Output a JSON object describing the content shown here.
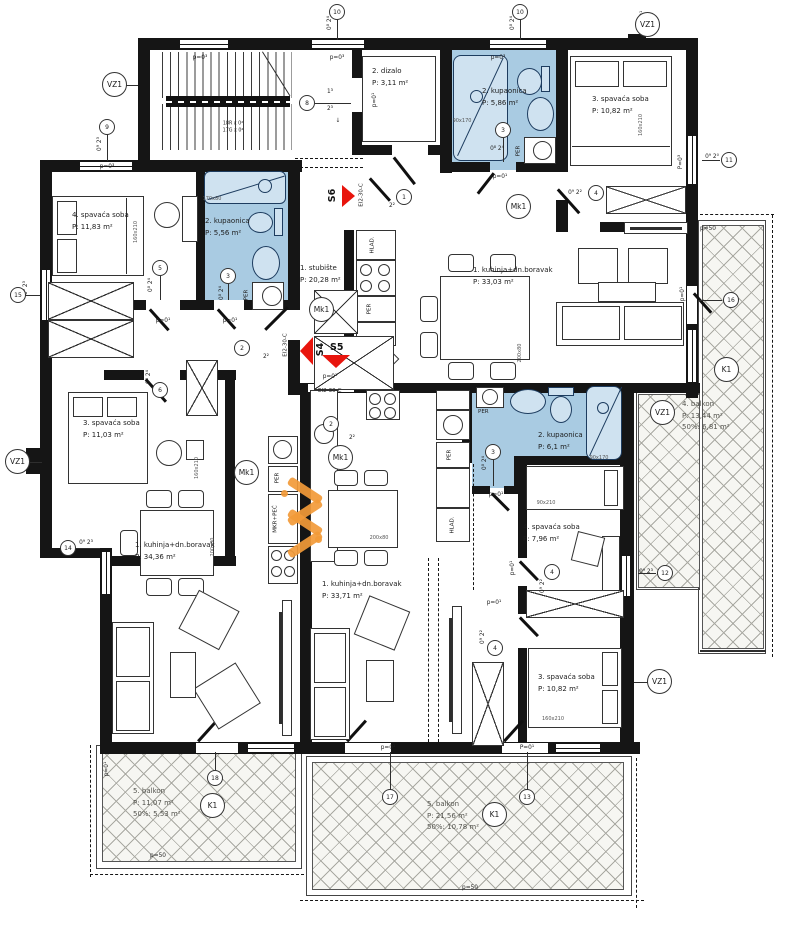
{
  "rooms": [
    {
      "name": "1. stubište",
      "area": "P: 20,28 m²"
    },
    {
      "name": "2. dizalo",
      "area": "P: 3,11 m²"
    },
    {
      "name": "2. kupaonica",
      "area": "P:      5,86 m²"
    },
    {
      "name": "3. spavaća soba",
      "area": "P:       10,82 m²"
    },
    {
      "name": "4. spavaća soba",
      "area": "P:       11,83 m²"
    },
    {
      "name": "2. kupaonica",
      "area": "P:      5,56 m²"
    },
    {
      "name": "1. kuhinja+dn.boravak",
      "area": "P:            33,03 m²"
    },
    {
      "name": "3. spavaća soba",
      "area": "P:       11,03 m²"
    },
    {
      "name": "1. kuhinja+dn.boravak",
      "area": "P:            34,36 m²"
    },
    {
      "name": "1. kuhinja+dn.boravak",
      "area": "P:            33,71 m²"
    },
    {
      "name": "2. kupaonica",
      "area": "P:      6,1 m²"
    },
    {
      "name": "4. spavaća soba",
      "area": "P:       7,96 m²"
    },
    {
      "name": "3. spavaća soba",
      "area": "P:       10,82 m²"
    },
    {
      "name": "4. balkon",
      "area": "P:    13,44 m²",
      "pct": "50%: 6,81 m²"
    },
    {
      "name": "5. balkon",
      "area": "P:    11,07 m²",
      "pct": "50%: 5,53 m²"
    },
    {
      "name": "5. balkon",
      "area": "P:    21,56 m²",
      "pct": "50%: 10,78 m²"
    }
  ],
  "labels": {
    "per": "PER",
    "hlad": "HLAD.",
    "mkr": "MKR+PEĆ",
    "ei": "EI2-30-C"
  },
  "stairs": {
    "line1": "18R x 0²",
    "line2": "17G x 0²"
  },
  "arrows": {
    "s4": "S4",
    "s5": "S5",
    "s6": "S6"
  },
  "colors": {
    "wall": "#151515",
    "bath_fill": "#a9cbe2",
    "arrow_red": "#e8150d",
    "watermark_orange": "#f29a38"
  },
  "markers": [
    {
      "t": "10",
      "x": 337,
      "y": 12
    },
    {
      "t": "10",
      "x": 520,
      "y": 12
    },
    {
      "t": "VZ1",
      "x": 115,
      "y": 85,
      "big": 1
    },
    {
      "t": "VZ1",
      "x": 648,
      "y": 25,
      "big": 1
    },
    {
      "t": "9",
      "x": 107,
      "y": 127
    },
    {
      "t": "8",
      "x": 307,
      "y": 103
    },
    {
      "t": "1",
      "x": 404,
      "y": 197
    },
    {
      "t": "Mk1",
      "x": 519,
      "y": 207,
      "big": 1
    },
    {
      "t": "3",
      "x": 503,
      "y": 130
    },
    {
      "t": "4",
      "x": 596,
      "y": 193
    },
    {
      "t": "11",
      "x": 729,
      "y": 160
    },
    {
      "t": "5",
      "x": 160,
      "y": 268
    },
    {
      "t": "3",
      "x": 228,
      "y": 276
    },
    {
      "t": "6",
      "x": 160,
      "y": 390
    },
    {
      "t": "15",
      "x": 18,
      "y": 295
    },
    {
      "t": "Mk1",
      "x": 322,
      "y": 310,
      "big": 1
    },
    {
      "t": "2",
      "x": 242,
      "y": 348
    },
    {
      "t": "2",
      "x": 331,
      "y": 424
    },
    {
      "t": "16",
      "x": 731,
      "y": 300
    },
    {
      "t": "K1",
      "x": 727,
      "y": 370,
      "big": 1
    },
    {
      "t": "VZ1",
      "x": 663,
      "y": 413,
      "big": 1
    },
    {
      "t": "VZ1",
      "x": 18,
      "y": 462,
      "big": 1
    },
    {
      "t": "Mk1",
      "x": 247,
      "y": 473,
      "big": 1
    },
    {
      "t": "Mk1",
      "x": 341,
      "y": 458,
      "big": 1
    },
    {
      "t": "3",
      "x": 493,
      "y": 452
    },
    {
      "t": "14",
      "x": 68,
      "y": 548
    },
    {
      "t": "4",
      "x": 552,
      "y": 572
    },
    {
      "t": "12",
      "x": 665,
      "y": 573
    },
    {
      "t": "4",
      "x": 495,
      "y": 648
    },
    {
      "t": "VZ1",
      "x": 660,
      "y": 682,
      "big": 1
    },
    {
      "t": "18",
      "x": 215,
      "y": 778
    },
    {
      "t": "K1",
      "x": 213,
      "y": 806,
      "big": 1
    },
    {
      "t": "17",
      "x": 390,
      "y": 797
    },
    {
      "t": "13",
      "x": 527,
      "y": 797
    },
    {
      "t": "K1",
      "x": 495,
      "y": 815,
      "big": 1
    }
  ],
  "tags": [
    {
      "t": "p=0³",
      "x": 200,
      "y": 58
    },
    {
      "t": "p=0³",
      "x": 337,
      "y": 58
    },
    {
      "t": "p=0³",
      "x": 498,
      "y": 58
    },
    {
      "t": "p=0³",
      "x": 107,
      "y": 167
    },
    {
      "t": "p=0¹",
      "x": 500,
      "y": 177
    },
    {
      "t": "p=0¹",
      "x": 375,
      "y": 100,
      "rot": 1
    },
    {
      "t": "p=0¹",
      "x": 643,
      "y": 18,
      "rot": 1
    },
    {
      "t": "P=0³",
      "x": 681,
      "y": 162,
      "rot": 1
    },
    {
      "t": "p=0¹",
      "x": 163,
      "y": 321
    },
    {
      "t": "p=0¹",
      "x": 230,
      "y": 321
    },
    {
      "t": "p=0¹",
      "x": 330,
      "y": 377
    },
    {
      "t": "p=0¹",
      "x": 683,
      "y": 294,
      "rot": 1
    },
    {
      "t": "p=0¹",
      "x": 496,
      "y": 495
    },
    {
      "t": "p=0¹",
      "x": 494,
      "y": 603
    },
    {
      "t": "p=0¹",
      "x": 513,
      "y": 568,
      "rot": 1
    },
    {
      "t": "P=0¹",
      "x": 527,
      "y": 748
    },
    {
      "t": "p=0¹",
      "x": 388,
      "y": 748
    },
    {
      "t": "p=0¹",
      "x": 107,
      "y": 769,
      "rot": 1
    },
    {
      "t": "p=50",
      "x": 708,
      "y": 229
    },
    {
      "t": "p=50",
      "x": 158,
      "y": 856
    },
    {
      "t": "p=50",
      "x": 470,
      "y": 888
    },
    {
      "t": "0⁸ 2⁴",
      "x": 330,
      "y": 23,
      "rot": 1
    },
    {
      "t": "0⁸ 2⁴",
      "x": 513,
      "y": 23,
      "rot": 1
    },
    {
      "t": "0⁹ 2³",
      "x": 100,
      "y": 144,
      "rot": 1
    },
    {
      "t": "1³",
      "x": 330,
      "y": 92
    },
    {
      "t": "2³",
      "x": 330,
      "y": 109
    },
    {
      "t": "↓",
      "x": 338,
      "y": 121
    },
    {
      "t": "0⁹ 2³",
      "x": 26,
      "y": 288,
      "rot": 1
    },
    {
      "t": "0⁹ 2³",
      "x": 86,
      "y": 543
    },
    {
      "t": "0⁹ 2⁰",
      "x": 712,
      "y": 157
    },
    {
      "t": "0⁹ 2³",
      "x": 646,
      "y": 572
    },
    {
      "t": "0⁸ 2⁴",
      "x": 497,
      "y": 149
    },
    {
      "t": "0⁸ 2⁴",
      "x": 222,
      "y": 293,
      "rot": 1
    },
    {
      "t": "0⁸ 2⁴",
      "x": 485,
      "y": 463,
      "rot": 1
    },
    {
      "t": "0⁹ 2²",
      "x": 575,
      "y": 193
    },
    {
      "t": "0⁹ 2²",
      "x": 543,
      "y": 586,
      "rot": 1
    },
    {
      "t": "0⁹ 2²",
      "x": 483,
      "y": 637,
      "rot": 1
    },
    {
      "t": "2²",
      "x": 392,
      "y": 206
    },
    {
      "t": "2²",
      "x": 266,
      "y": 357
    },
    {
      "t": "2²",
      "x": 352,
      "y": 438
    },
    {
      "t": "0⁸ 2⁴",
      "x": 151,
      "y": 285,
      "rot": 1
    },
    {
      "t": "0⁸ 2⁴",
      "x": 149,
      "y": 377,
      "rot": 1
    }
  ],
  "dims": [
    {
      "t": "160x210",
      "x": 136,
      "y": 232,
      "rot": 1
    },
    {
      "t": "160x210",
      "x": 641,
      "y": 125,
      "rot": 1
    },
    {
      "t": "160x210",
      "x": 197,
      "y": 468,
      "rot": 1
    },
    {
      "t": "90x170",
      "x": 462,
      "y": 121
    },
    {
      "t": "90x170",
      "x": 599,
      "y": 458
    },
    {
      "t": "90x210",
      "x": 546,
      "y": 503
    },
    {
      "t": "160x210",
      "x": 553,
      "y": 719
    },
    {
      "t": "200x80",
      "x": 520,
      "y": 353,
      "rot": 1
    },
    {
      "t": "200x80",
      "x": 213,
      "y": 547,
      "rot": 1
    },
    {
      "t": "200x80",
      "x": 379,
      "y": 538
    },
    {
      "t": "170x80",
      "x": 212,
      "y": 199
    }
  ]
}
